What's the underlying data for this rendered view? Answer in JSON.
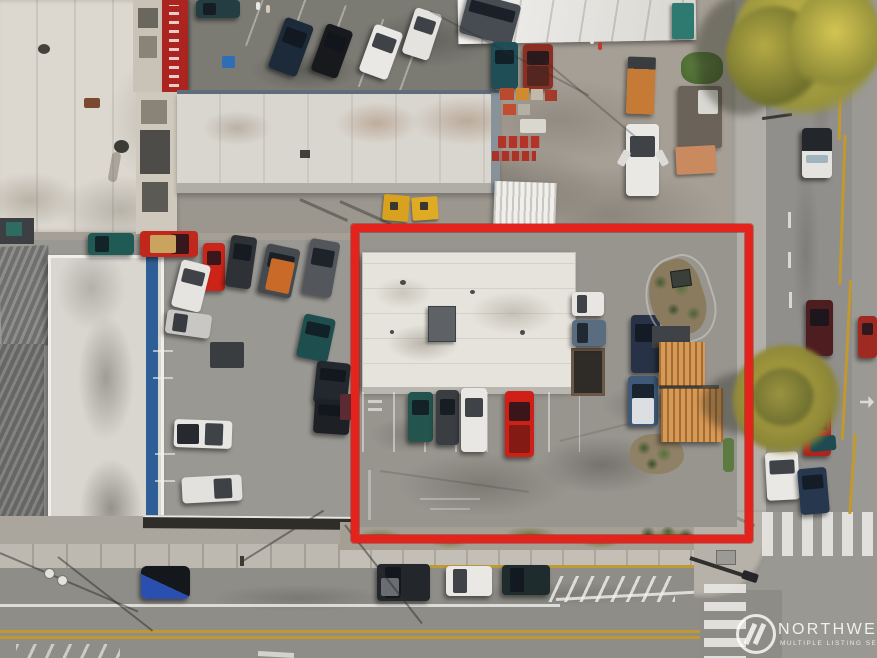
{
  "image": {
    "kind": "aerial-drone-real-estate-photo",
    "subject": "Overhead aerial view of a commercial property and parking lot at a street corner, outlined with a red property boundary",
    "boundary_color": "#e3231c"
  },
  "watermark": {
    "logo_icon": "nwmls-circle-slashes-icon",
    "title": "NORTHWEST",
    "subtitle": "MULTIPLE LISTING SERVICE."
  }
}
